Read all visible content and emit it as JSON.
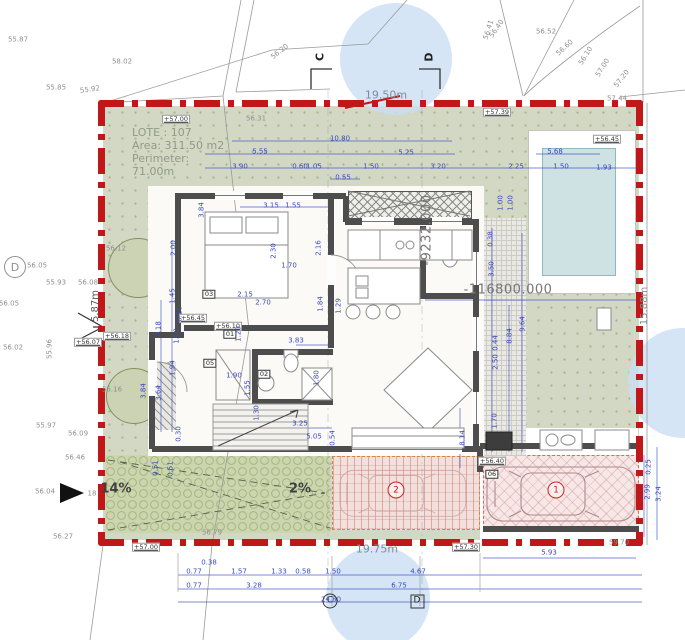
{
  "lote": {
    "line1": "LOTE : 107",
    "line2": "Area: 311.50 m2",
    "line3": "Perimeter:",
    "line4": "71.00m"
  },
  "boundary_dims": {
    "top": "19.50m",
    "bottom": "19.75m",
    "right": "15.88m",
    "left": "5.87m"
  },
  "slopes": {
    "driveway": "14%",
    "ramp": "2%"
  },
  "parking": {
    "p1": "1",
    "p2": "2"
  },
  "sections": {
    "c_top": "C",
    "d_top": "D",
    "c_bottom": "C",
    "d_bottom": "D",
    "d_circle": "D"
  },
  "cad_coords": {
    "x": "-9232.000",
    "y": "-116800.000"
  },
  "colors": {
    "boundary_red": "#c01818",
    "dim_blue": "#3a49c0",
    "garden_green": "#d3d8c5",
    "pool_water": "#cfe2e3",
    "parking_pink": "#f7e7e7",
    "driveway_green": "#ccd6ae",
    "survey_gray": "#8f8f8f",
    "wall_gray": "#4d4d4d"
  },
  "label_groups": [
    {
      "name": "survey-elevation-label",
      "cls": "gray",
      "items": [
        {
          "t": "55.87",
          "x": 18,
          "y": 40
        },
        {
          "t": "58.02",
          "x": 122,
          "y": 62
        },
        {
          "t": "55.85",
          "x": 56,
          "y": 88
        },
        {
          "t": "55.92",
          "x": 90,
          "y": 90,
          "r": -8
        },
        {
          "t": "56.20",
          "x": 280,
          "y": 52,
          "r": -38
        },
        {
          "t": "56.41",
          "x": 489,
          "y": 30,
          "r": -72
        },
        {
          "t": "56.52",
          "x": 546,
          "y": 32
        },
        {
          "t": "56.40",
          "x": 497,
          "y": 29,
          "r": -55
        },
        {
          "t": "56.60",
          "x": 565,
          "y": 48,
          "r": -42
        },
        {
          "t": "56.10",
          "x": 586,
          "y": 56,
          "r": -58
        },
        {
          "t": "57.00",
          "x": 603,
          "y": 68,
          "r": -58
        },
        {
          "t": "57.20",
          "x": 622,
          "y": 79,
          "r": -52
        },
        {
          "t": "57.44",
          "x": 617,
          "y": 99
        },
        {
          "t": "56.31",
          "x": 256,
          "y": 119
        },
        {
          "t": "56.12",
          "x": 116,
          "y": 249
        },
        {
          "t": "56.05",
          "x": 37,
          "y": 266
        },
        {
          "t": "55.93",
          "x": 56,
          "y": 283
        },
        {
          "t": "56.08",
          "x": 88,
          "y": 283
        },
        {
          "t": "56.05",
          "x": 9,
          "y": 304
        },
        {
          "t": "55.96",
          "x": 50,
          "y": 349,
          "r": -90
        },
        {
          "t": "56.02",
          "x": 13,
          "y": 348
        },
        {
          "t": "56.16",
          "x": 112,
          "y": 390
        },
        {
          "t": "55.97",
          "x": 46,
          "y": 426
        },
        {
          "t": "56.09",
          "x": 78,
          "y": 434
        },
        {
          "t": "56.46",
          "x": 75,
          "y": 458
        },
        {
          "t": "56.04",
          "x": 45,
          "y": 492
        },
        {
          "t": "18",
          "x": 92,
          "y": 494
        },
        {
          "t": "56.27",
          "x": 63,
          "y": 537
        },
        {
          "t": "56.79",
          "x": 212,
          "y": 533
        },
        {
          "t": "59.70",
          "x": 619,
          "y": 543
        }
      ]
    },
    {
      "name": "elevation-marker",
      "cls": "mark",
      "items": [
        {
          "t": "+57.00",
          "x": 176,
          "y": 119
        },
        {
          "t": "+57.39",
          "x": 497,
          "y": 112
        },
        {
          "t": "+56.45",
          "x": 607,
          "y": 139
        },
        {
          "t": "+56.07",
          "x": 88,
          "y": 342
        },
        {
          "t": "+56.18",
          "x": 117,
          "y": 336
        },
        {
          "t": "+56.45",
          "x": 193,
          "y": 318
        },
        {
          "t": "+56.10",
          "x": 228,
          "y": 326
        },
        {
          "t": "+56.40",
          "x": 492,
          "y": 461
        },
        {
          "t": "+57.00",
          "x": 146,
          "y": 547
        },
        {
          "t": "+57.30",
          "x": 466,
          "y": 547
        }
      ]
    },
    {
      "name": "door-tag",
      "cls": "tag",
      "items": [
        {
          "t": "03",
          "x": 209,
          "y": 294
        },
        {
          "t": "01",
          "x": 230,
          "y": 334
        },
        {
          "t": "02",
          "x": 264,
          "y": 374
        },
        {
          "t": "05",
          "x": 210,
          "y": 363
        },
        {
          "t": "06",
          "x": 492,
          "y": 474
        }
      ]
    },
    {
      "name": "dimension-label",
      "cls": "dim",
      "items": [
        {
          "t": "10.80",
          "x": 340,
          "y": 139
        },
        {
          "t": "5.55",
          "x": 260,
          "y": 152
        },
        {
          "t": "5.25",
          "x": 406,
          "y": 153
        },
        {
          "t": "5.68",
          "x": 555,
          "y": 152
        },
        {
          "t": "3.90",
          "x": 240,
          "y": 167
        },
        {
          "t": "0.60",
          "x": 300,
          "y": 167
        },
        {
          "t": "1.05",
          "x": 314,
          "y": 167
        },
        {
          "t": "1.50",
          "x": 371,
          "y": 167
        },
        {
          "t": "3.20",
          "x": 438,
          "y": 167
        },
        {
          "t": "2.25",
          "x": 516,
          "y": 167
        },
        {
          "t": "1.50",
          "x": 561,
          "y": 167
        },
        {
          "t": "1.93",
          "x": 604,
          "y": 168
        },
        {
          "t": "0.55",
          "x": 343,
          "y": 178
        },
        {
          "t": "0.38",
          "x": 209,
          "y": 563
        },
        {
          "t": "0.77",
          "x": 194,
          "y": 572
        },
        {
          "t": "1.57",
          "x": 239,
          "y": 572
        },
        {
          "t": "1.33",
          "x": 279,
          "y": 572
        },
        {
          "t": "0.58",
          "x": 303,
          "y": 572
        },
        {
          "t": "1.50",
          "x": 333,
          "y": 572
        },
        {
          "t": "4.67",
          "x": 418,
          "y": 572
        },
        {
          "t": "0.77",
          "x": 194,
          "y": 586
        },
        {
          "t": "3.28",
          "x": 254,
          "y": 586
        },
        {
          "t": "6.75",
          "x": 399,
          "y": 586
        },
        {
          "t": "24.80",
          "x": 331,
          "y": 600
        },
        {
          "t": "5.93",
          "x": 549,
          "y": 553
        },
        {
          "t": "3.15",
          "x": 271,
          "y": 206
        },
        {
          "t": "1.55",
          "x": 293,
          "y": 206
        },
        {
          "t": "1.70",
          "x": 289,
          "y": 266
        },
        {
          "t": "2.15",
          "x": 245,
          "y": 295
        },
        {
          "t": "2.70",
          "x": 263,
          "y": 303
        },
        {
          "t": "3.83",
          "x": 296,
          "y": 341
        },
        {
          "t": "1.90",
          "x": 234,
          "y": 376
        },
        {
          "t": "3.25",
          "x": 300,
          "y": 424
        },
        {
          "t": "5.05",
          "x": 314,
          "y": 437
        },
        {
          "t": "0.25",
          "x": 649,
          "y": 467,
          "r": -90
        },
        {
          "t": "2.99",
          "x": 648,
          "y": 492,
          "r": -90
        },
        {
          "t": "3.24",
          "x": 659,
          "y": 494,
          "r": -90
        },
        {
          "t": "3.84",
          "x": 202,
          "y": 210,
          "r": -90
        },
        {
          "t": "2.30",
          "x": 274,
          "y": 251,
          "r": -90
        },
        {
          "t": "2.16",
          "x": 319,
          "y": 248,
          "r": -90
        },
        {
          "t": "1.84",
          "x": 321,
          "y": 304,
          "r": -90
        },
        {
          "t": "1.29",
          "x": 339,
          "y": 306,
          "r": -90
        },
        {
          "t": "1.20",
          "x": 239,
          "y": 334,
          "r": -90
        },
        {
          "t": "1.80",
          "x": 317,
          "y": 378,
          "r": -90
        },
        {
          "t": "1.55",
          "x": 248,
          "y": 388,
          "r": -90
        },
        {
          "t": "1.30",
          "x": 257,
          "y": 413,
          "r": -90
        },
        {
          "t": "0.54",
          "x": 333,
          "y": 438,
          "r": -90
        },
        {
          "t": "1.00",
          "x": 501,
          "y": 203,
          "r": -90
        },
        {
          "t": "1.00",
          "x": 511,
          "y": 203,
          "r": -90
        },
        {
          "t": "0.38",
          "x": 491,
          "y": 239,
          "r": -90
        },
        {
          "t": "3.50",
          "x": 492,
          "y": 269,
          "r": -90
        },
        {
          "t": "0.44",
          "x": 496,
          "y": 343,
          "r": -90
        },
        {
          "t": "2.50",
          "x": 496,
          "y": 362,
          "r": -90
        },
        {
          "t": "8.84",
          "x": 510,
          "y": 336,
          "r": -90
        },
        {
          "t": "9.64",
          "x": 523,
          "y": 324,
          "r": -90
        },
        {
          "t": "1.70",
          "x": 495,
          "y": 421,
          "r": -90
        },
        {
          "t": "8.14",
          "x": 463,
          "y": 438,
          "r": -90
        },
        {
          "t": "4.18",
          "x": 159,
          "y": 329,
          "r": -90
        },
        {
          "t": "2.00",
          "x": 174,
          "y": 248,
          "r": -90
        },
        {
          "t": "1.45",
          "x": 173,
          "y": 296,
          "r": -90
        },
        {
          "t": "0.16",
          "x": 180,
          "y": 314,
          "r": -90
        },
        {
          "t": "1.00",
          "x": 177,
          "y": 336,
          "r": -90
        },
        {
          "t": "1.94",
          "x": 173,
          "y": 368,
          "r": -90
        },
        {
          "t": "3.64",
          "x": 159,
          "y": 393,
          "r": -90
        },
        {
          "t": "3.84",
          "x": 144,
          "y": 391,
          "r": -90
        },
        {
          "t": "0.51",
          "x": 156,
          "y": 468,
          "r": -90
        },
        {
          "t": "0.51",
          "x": 171,
          "y": 469,
          "r": -90
        },
        {
          "t": "0.30",
          "x": 179,
          "y": 434,
          "r": -90
        }
      ]
    }
  ]
}
